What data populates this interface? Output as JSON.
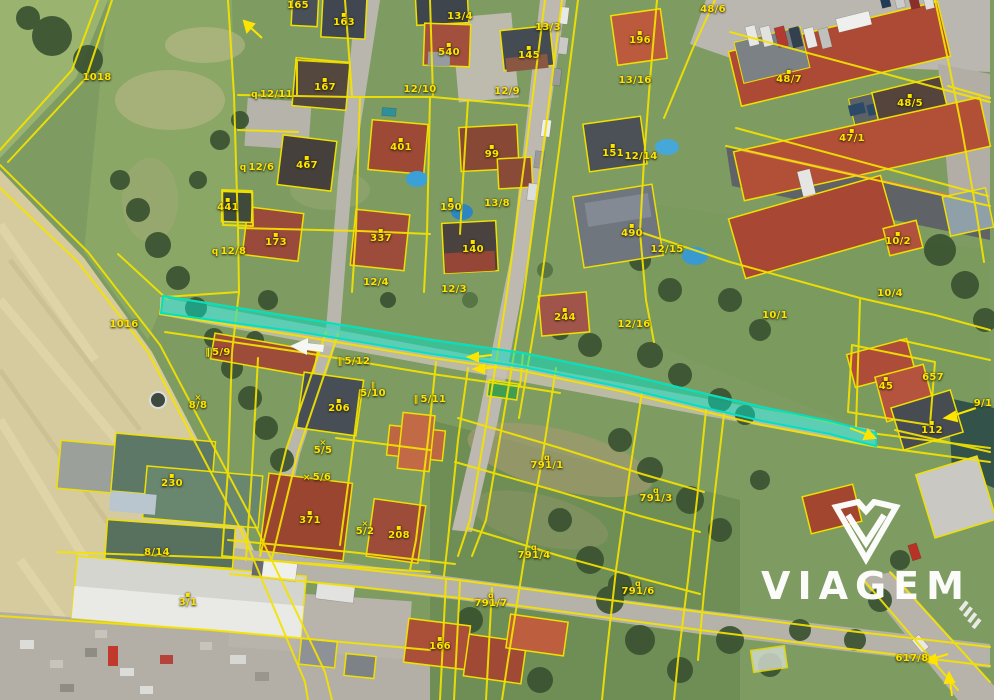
{
  "map": {
    "type": "aerial-cadastral-map",
    "colors": {
      "cadastral_line": "#f4e300",
      "label_text": "#ffe400",
      "highlight_parcel": "#00e0c4",
      "watermark": "#ffffff"
    },
    "highlight": {
      "kind": "selected-parcel-strip",
      "color": "#00e0c4"
    },
    "symbol_glyphs": {
      "dot": "▪",
      "bars": "∥",
      "x": "×",
      "q": "q"
    },
    "labels": [
      {
        "text": "1018",
        "x": 97,
        "y": 78
      },
      {
        "text": "1016",
        "x": 124,
        "y": 325
      },
      {
        "text": "165",
        "x": 298,
        "y": 6
      },
      {
        "text": "163",
        "x": 344,
        "y": 20,
        "icon": "dot",
        "ipos": "above"
      },
      {
        "text": "13/4",
        "x": 460,
        "y": 17
      },
      {
        "text": "13/3",
        "x": 548,
        "y": 28
      },
      {
        "text": "540",
        "x": 449,
        "y": 50,
        "icon": "dot",
        "ipos": "above"
      },
      {
        "text": "145",
        "x": 529,
        "y": 53,
        "icon": "dot",
        "ipos": "above"
      },
      {
        "text": "196",
        "x": 640,
        "y": 38,
        "icon": "dot",
        "ipos": "above"
      },
      {
        "text": "48/6",
        "x": 713,
        "y": 10
      },
      {
        "text": "48/7",
        "x": 789,
        "y": 77,
        "icon": "dot",
        "ipos": "above"
      },
      {
        "text": "48/5",
        "x": 910,
        "y": 101,
        "icon": "dot",
        "ipos": "above"
      },
      {
        "text": "47/1",
        "x": 852,
        "y": 136,
        "icon": "dot",
        "ipos": "above"
      },
      {
        "text": "12/11",
        "x": 272,
        "y": 95,
        "icon": "q",
        "ipos": "left"
      },
      {
        "text": "12/10",
        "x": 420,
        "y": 90
      },
      {
        "text": "12/9",
        "x": 507,
        "y": 92
      },
      {
        "text": "13/16",
        "x": 635,
        "y": 81
      },
      {
        "text": "167",
        "x": 325,
        "y": 85,
        "icon": "dot",
        "ipos": "above"
      },
      {
        "text": "151",
        "x": 613,
        "y": 151,
        "icon": "dot",
        "ipos": "above"
      },
      {
        "text": "12/14",
        "x": 641,
        "y": 157
      },
      {
        "text": "12/6",
        "x": 257,
        "y": 168,
        "icon": "q",
        "ipos": "left"
      },
      {
        "text": "441",
        "x": 228,
        "y": 205,
        "icon": "dot",
        "ipos": "above"
      },
      {
        "text": "173",
        "x": 276,
        "y": 240,
        "icon": "dot",
        "ipos": "above"
      },
      {
        "text": "12/8",
        "x": 229,
        "y": 252,
        "icon": "q",
        "ipos": "left"
      },
      {
        "text": "467",
        "x": 307,
        "y": 163,
        "icon": "dot",
        "ipos": "above"
      },
      {
        "text": "401",
        "x": 401,
        "y": 145,
        "icon": "dot",
        "ipos": "above"
      },
      {
        "text": "99",
        "x": 492,
        "y": 152,
        "icon": "dot",
        "ipos": "above"
      },
      {
        "text": "337",
        "x": 381,
        "y": 236,
        "icon": "dot",
        "ipos": "above"
      },
      {
        "text": "140",
        "x": 473,
        "y": 247,
        "icon": "dot",
        "ipos": "above"
      },
      {
        "text": "190",
        "x": 451,
        "y": 205,
        "icon": "dot",
        "ipos": "above"
      },
      {
        "text": "13/8",
        "x": 497,
        "y": 204
      },
      {
        "text": "12/4",
        "x": 376,
        "y": 283
      },
      {
        "text": "12/3",
        "x": 454,
        "y": 290
      },
      {
        "text": "490",
        "x": 632,
        "y": 231,
        "icon": "dot",
        "ipos": "above"
      },
      {
        "text": "12/15",
        "x": 667,
        "y": 250
      },
      {
        "text": "244",
        "x": 565,
        "y": 315,
        "icon": "dot",
        "ipos": "above"
      },
      {
        "text": "12/16",
        "x": 634,
        "y": 325
      },
      {
        "text": "10/1",
        "x": 775,
        "y": 316
      },
      {
        "text": "10/2",
        "x": 898,
        "y": 239,
        "icon": "dot",
        "ipos": "above"
      },
      {
        "text": "10/4",
        "x": 890,
        "y": 294
      },
      {
        "text": "5/9",
        "x": 218,
        "y": 353,
        "icon": "bars",
        "ipos": "left"
      },
      {
        "text": "5/12",
        "x": 354,
        "y": 362,
        "icon": "bars",
        "ipos": "left"
      },
      {
        "text": "8/8",
        "x": 198,
        "y": 403,
        "icon": "x",
        "ipos": "above"
      },
      {
        "text": "5/10",
        "x": 373,
        "y": 391,
        "icon": "bars",
        "ipos": "above"
      },
      {
        "text": "5/11",
        "x": 430,
        "y": 400,
        "icon": "bars",
        "ipos": "left"
      },
      {
        "text": "206",
        "x": 339,
        "y": 406,
        "icon": "dot",
        "ipos": "above"
      },
      {
        "text": "5/5",
        "x": 323,
        "y": 448,
        "icon": "x",
        "ipos": "above"
      },
      {
        "text": "5/6",
        "x": 317,
        "y": 478,
        "icon": "x",
        "ipos": "left"
      },
      {
        "text": "5/2",
        "x": 365,
        "y": 529,
        "icon": "x",
        "ipos": "above"
      },
      {
        "text": "230",
        "x": 172,
        "y": 481,
        "icon": "dot",
        "ipos": "above"
      },
      {
        "text": "371",
        "x": 310,
        "y": 518,
        "icon": "dot",
        "ipos": "above"
      },
      {
        "text": "208",
        "x": 399,
        "y": 533,
        "icon": "dot",
        "ipos": "above"
      },
      {
        "text": "8/14",
        "x": 157,
        "y": 553
      },
      {
        "text": "3/1",
        "x": 188,
        "y": 600,
        "icon": "dot",
        "ipos": "above"
      },
      {
        "text": "166",
        "x": 440,
        "y": 644,
        "icon": "dot",
        "ipos": "above"
      },
      {
        "text": "791/1",
        "x": 547,
        "y": 463,
        "icon": "q",
        "ipos": "above"
      },
      {
        "text": "791/3",
        "x": 656,
        "y": 496,
        "icon": "q",
        "ipos": "above"
      },
      {
        "text": "791/4",
        "x": 534,
        "y": 553,
        "icon": "q",
        "ipos": "above"
      },
      {
        "text": "791/6",
        "x": 638,
        "y": 589,
        "icon": "q",
        "ipos": "above"
      },
      {
        "text": "791/7",
        "x": 491,
        "y": 601,
        "icon": "q",
        "ipos": "above"
      },
      {
        "text": "45",
        "x": 886,
        "y": 384,
        "icon": "dot",
        "ipos": "above"
      },
      {
        "text": "657",
        "x": 933,
        "y": 378
      },
      {
        "text": "9/1",
        "x": 983,
        "y": 404
      },
      {
        "text": "112",
        "x": 932,
        "y": 428,
        "icon": "dot",
        "ipos": "above"
      },
      {
        "text": "617/8",
        "x": 912,
        "y": 659
      }
    ]
  },
  "watermark": {
    "text": "VIAGEM"
  }
}
